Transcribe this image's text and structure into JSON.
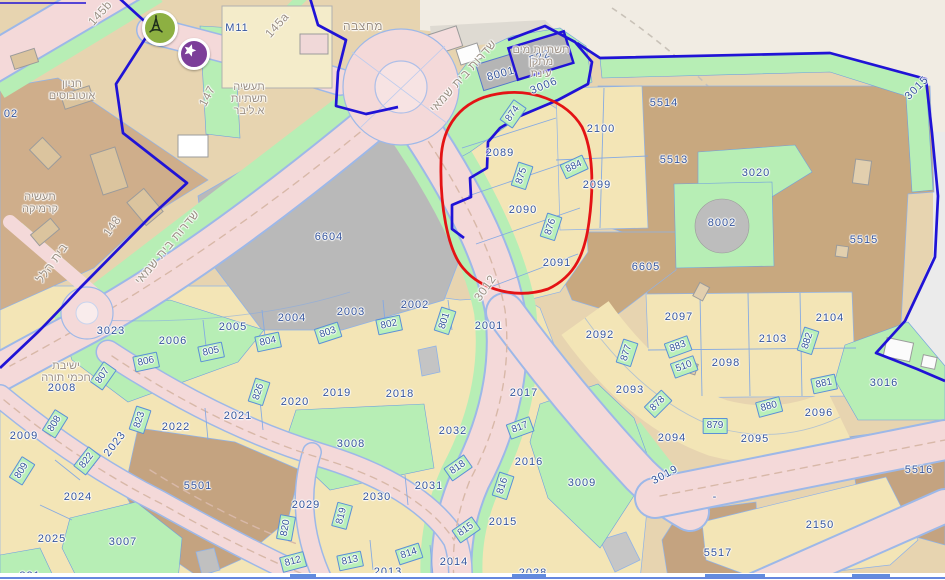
{
  "map": {
    "colors": {
      "parcel_label": "#34549c",
      "street_label": "#9c9084",
      "road_fill": "#f4d9d9",
      "road_edge": "#9db8e8",
      "green_area": "#b7eeb5",
      "green_plot": "#b9f0b9",
      "plot_border": "#5b8fd8",
      "municipal_boundary_blue": "#2013d6",
      "annotation_red": "#e41315",
      "gray_parcel": "#b9b9b9",
      "tan_area": "#e7d4b0",
      "brown_area": "#c8a87f",
      "yellow_lot": "#f3e5b6",
      "marker_green": "#8db042",
      "marker_purple": "#7c3e99"
    },
    "icons": [
      {
        "name": "eiffel-tower-marker"
      },
      {
        "name": "star-marker"
      }
    ],
    "labels": {
      "parcels": [
        {
          "t": "02",
          "x": 11,
          "y": 114
        },
        {
          "t": "M11",
          "x": 237,
          "y": 28
        },
        {
          "t": "8001",
          "x": 501,
          "y": 74,
          "r": -15
        },
        {
          "t": "522",
          "x": 540,
          "y": 57,
          "r": -20
        },
        {
          "t": "3006",
          "x": 544,
          "y": 86,
          "r": -22
        },
        {
          "t": "2089",
          "x": 500,
          "y": 153
        },
        {
          "t": "2090",
          "x": 523,
          "y": 210
        },
        {
          "t": "2091",
          "x": 557,
          "y": 263
        },
        {
          "t": "2100",
          "x": 601,
          "y": 129
        },
        {
          "t": "2099",
          "x": 597,
          "y": 185
        },
        {
          "t": "5514",
          "x": 664,
          "y": 103
        },
        {
          "t": "5513",
          "x": 674,
          "y": 160
        },
        {
          "t": "3020",
          "x": 756,
          "y": 173
        },
        {
          "t": "8002",
          "x": 722,
          "y": 223
        },
        {
          "t": "5515",
          "x": 864,
          "y": 240
        },
        {
          "t": "3015",
          "x": 917,
          "y": 88,
          "r": -45
        },
        {
          "t": "6605",
          "x": 646,
          "y": 267
        },
        {
          "t": "6604",
          "x": 329,
          "y": 237
        },
        {
          "t": "3023",
          "x": 111,
          "y": 331
        },
        {
          "t": "2006",
          "x": 173,
          "y": 341
        },
        {
          "t": "2005",
          "x": 233,
          "y": 327
        },
        {
          "t": "2004",
          "x": 292,
          "y": 318
        },
        {
          "t": "2003",
          "x": 351,
          "y": 312
        },
        {
          "t": "2002",
          "x": 415,
          "y": 305
        },
        {
          "t": "2001",
          "x": 489,
          "y": 326
        },
        {
          "t": "2008",
          "x": 62,
          "y": 388
        },
        {
          "t": "2009",
          "x": 24,
          "y": 436
        },
        {
          "t": "2023",
          "x": 115,
          "y": 444,
          "r": -52
        },
        {
          "t": "2022",
          "x": 176,
          "y": 427
        },
        {
          "t": "2021",
          "x": 238,
          "y": 416
        },
        {
          "t": "2020",
          "x": 295,
          "y": 402
        },
        {
          "t": "2024",
          "x": 78,
          "y": 497
        },
        {
          "t": "2025",
          "x": 52,
          "y": 539
        },
        {
          "t": "3007",
          "x": 123,
          "y": 542
        },
        {
          "t": "5501",
          "x": 198,
          "y": 486
        },
        {
          "t": "2029",
          "x": 306,
          "y": 505
        },
        {
          "t": "2030",
          "x": 377,
          "y": 497
        },
        {
          "t": "2031",
          "x": 429,
          "y": 486
        },
        {
          "t": "2032",
          "x": 453,
          "y": 431
        },
        {
          "t": "3008",
          "x": 351,
          "y": 444
        },
        {
          "t": "2019",
          "x": 337,
          "y": 393
        },
        {
          "t": "2018",
          "x": 400,
          "y": 394
        },
        {
          "t": "2017",
          "x": 524,
          "y": 393
        },
        {
          "t": "2016",
          "x": 529,
          "y": 462
        },
        {
          "t": "2015",
          "x": 503,
          "y": 522
        },
        {
          "t": "2014",
          "x": 454,
          "y": 562
        },
        {
          "t": "2013",
          "x": 388,
          "y": 572
        },
        {
          "t": "2028",
          "x": 533,
          "y": 573
        },
        {
          "t": "821",
          "x": 30,
          "y": 576
        },
        {
          "t": "3009",
          "x": 582,
          "y": 483
        },
        {
          "t": "3019",
          "x": 665,
          "y": 475,
          "r": -28
        },
        {
          "t": "2093",
          "x": 630,
          "y": 390
        },
        {
          "t": "2092",
          "x": 600,
          "y": 335
        },
        {
          "t": "2094",
          "x": 672,
          "y": 438
        },
        {
          "t": "2095",
          "x": 755,
          "y": 439
        },
        {
          "t": "2096",
          "x": 819,
          "y": 413
        },
        {
          "t": "2097",
          "x": 679,
          "y": 317
        },
        {
          "t": "2098",
          "x": 726,
          "y": 363
        },
        {
          "t": "2103",
          "x": 773,
          "y": 339
        },
        {
          "t": "2104",
          "x": 830,
          "y": 318
        },
        {
          "t": "3016",
          "x": 884,
          "y": 383
        },
        {
          "t": "5516",
          "x": 919,
          "y": 470
        },
        {
          "t": "2150",
          "x": 820,
          "y": 525
        },
        {
          "t": "5517",
          "x": 718,
          "y": 553
        },
        {
          "t": "-",
          "x": 715,
          "y": 497
        },
        {
          "t": "874",
          "x": 513,
          "y": 114,
          "r": -55,
          "g": 1
        },
        {
          "t": "875",
          "x": 522,
          "y": 176,
          "r": -72,
          "g": 1
        },
        {
          "t": "876",
          "x": 551,
          "y": 227,
          "r": -72,
          "g": 1
        },
        {
          "t": "884",
          "x": 574,
          "y": 167,
          "r": -25,
          "g": 1
        },
        {
          "t": "801",
          "x": 445,
          "y": 321,
          "r": -72,
          "g": 1
        },
        {
          "t": "802",
          "x": 389,
          "y": 325,
          "r": -12,
          "g": 1
        },
        {
          "t": "803",
          "x": 328,
          "y": 333,
          "r": -18,
          "g": 1
        },
        {
          "t": "804",
          "x": 268,
          "y": 342,
          "r": -12,
          "g": 1
        },
        {
          "t": "805",
          "x": 211,
          "y": 352,
          "r": -12,
          "g": 1
        },
        {
          "t": "806",
          "x": 146,
          "y": 362,
          "r": -12,
          "g": 1
        },
        {
          "t": "807",
          "x": 103,
          "y": 376,
          "r": -55,
          "g": 1
        },
        {
          "t": "808",
          "x": 55,
          "y": 424,
          "r": -58,
          "g": 1
        },
        {
          "t": "809",
          "x": 22,
          "y": 471,
          "r": -58,
          "g": 1
        },
        {
          "t": "822",
          "x": 87,
          "y": 461,
          "r": -52,
          "g": 1
        },
        {
          "t": "823",
          "x": 140,
          "y": 420,
          "r": -72,
          "g": 1
        },
        {
          "t": "826",
          "x": 259,
          "y": 392,
          "r": -72,
          "g": 1
        },
        {
          "t": "820",
          "x": 286,
          "y": 528,
          "r": -80,
          "g": 1
        },
        {
          "t": "819",
          "x": 342,
          "y": 516,
          "r": -75,
          "g": 1
        },
        {
          "t": "818",
          "x": 458,
          "y": 468,
          "r": -35,
          "g": 1
        },
        {
          "t": "817",
          "x": 520,
          "y": 428,
          "r": -20,
          "g": 1
        },
        {
          "t": "816",
          "x": 503,
          "y": 486,
          "r": -72,
          "g": 1
        },
        {
          "t": "815",
          "x": 466,
          "y": 530,
          "r": -35,
          "g": 1
        },
        {
          "t": "814",
          "x": 409,
          "y": 554,
          "r": -18,
          "g": 1
        },
        {
          "t": "813",
          "x": 350,
          "y": 561,
          "r": -12,
          "g": 1
        },
        {
          "t": "812",
          "x": 293,
          "y": 562,
          "r": -15,
          "g": 1
        },
        {
          "t": "877",
          "x": 627,
          "y": 353,
          "r": -72,
          "g": 1
        },
        {
          "t": "883",
          "x": 678,
          "y": 347,
          "r": -20,
          "g": 1
        },
        {
          "t": "510",
          "x": 684,
          "y": 367,
          "r": -20,
          "g": 1
        },
        {
          "t": "882",
          "x": 808,
          "y": 341,
          "r": -72,
          "g": 1
        },
        {
          "t": "878",
          "x": 658,
          "y": 404,
          "r": -45,
          "g": 1
        },
        {
          "t": "879",
          "x": 715,
          "y": 426,
          "g": 1
        },
        {
          "t": "880",
          "x": 769,
          "y": 407,
          "r": -15,
          "g": 1
        },
        {
          "t": "881",
          "x": 824,
          "y": 384,
          "r": -12,
          "g": 1
        }
      ],
      "streets": [
        {
          "t": "שדרות בית שמאי",
          "x": 463,
          "y": 76,
          "r": -48
        },
        {
          "t": "שדרות בית שמאי",
          "x": 167,
          "y": 247,
          "r": -50
        },
        {
          "t": "בית הלל",
          "x": 52,
          "y": 263,
          "r": -55
        },
        {
          "t": "148",
          "x": 112,
          "y": 226,
          "r": -55
        },
        {
          "t": "147",
          "x": 207,
          "y": 96,
          "r": -62
        },
        {
          "t": "145a",
          "x": 277,
          "y": 25,
          "r": -48
        },
        {
          "t": "145b",
          "x": 100,
          "y": 13,
          "r": -48
        },
        {
          "t": "3012",
          "x": 485,
          "y": 288,
          "r": -55
        },
        {
          "t": "מחצבה",
          "x": 363,
          "y": 26,
          "r": 0
        }
      ],
      "areas": [
        {
          "lines": [
            "חניון",
            "אוטובוסים"
          ],
          "x": 72,
          "y": 90
        },
        {
          "lines": [
            "תעשיה",
            "תשתיות",
            "א.ליבר"
          ],
          "x": 249,
          "y": 99
        },
        {
          "lines": [
            "תעשיה",
            "קרמיקה"
          ],
          "x": 40,
          "y": 203
        },
        {
          "lines": [
            "תשתיות מים",
            "מתקן",
            "עינת"
          ],
          "x": 541,
          "y": 62
        },
        {
          "lines": [
            "ישיבת",
            "חכמי תורה"
          ],
          "x": 66,
          "y": 372
        }
      ]
    },
    "bottom_strip": {
      "fragments": [
        {
          "x": 290,
          "w": 26
        },
        {
          "x": 512,
          "w": 34
        },
        {
          "x": 705,
          "w": 60
        },
        {
          "x": 852,
          "w": 38
        }
      ]
    }
  }
}
